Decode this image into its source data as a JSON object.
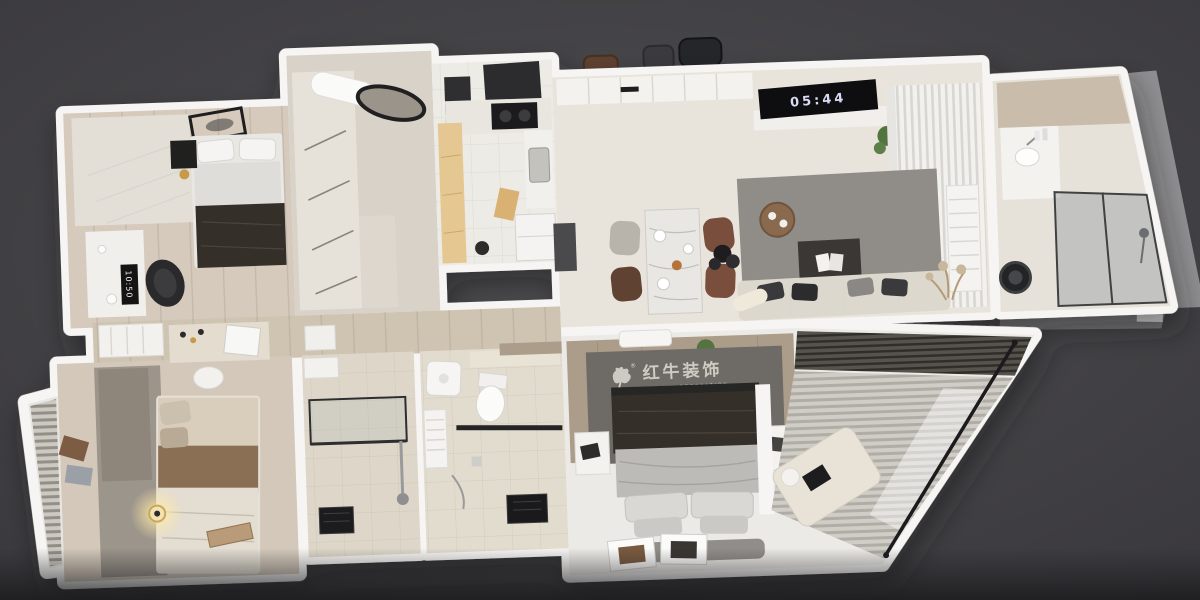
{
  "scene": {
    "background_color": "#4a494c",
    "background_edge_color": "#37363a",
    "floor_shadow_color": "#1c1c1e"
  },
  "branding": {
    "logo_text": "红牛装饰",
    "logo_subtext": "HONG NIU DECORATION",
    "trademark_symbol": "®",
    "logo_color": "#d8d4cc",
    "logo_icon": "bull-icon"
  },
  "displays": {
    "desk_clock_time": "10:50",
    "tv_clock_time": "05:44"
  },
  "palette": {
    "wall": "#f6f5f3",
    "floor_wood_light": "#d5cabb",
    "floor_closet": "#d8d2c9",
    "floor_kitchen": "#edebe6",
    "floor_cream": "#e9e4db",
    "floor_hall": "#cfc4b2",
    "floor_bedroom_bl": "#d3c8b9",
    "floor_bath_a": "#ded7c9",
    "floor_bath_b": "#e2dccf",
    "floor_bath_right": "#e6e2da",
    "floor_white": "#eceae6",
    "wood_cabinet": "#e5c791",
    "wood_wall": "#ab9d8a",
    "rug_dark": "#6e6a65",
    "rug_gray": "#908d88",
    "rug_bl": "#9c958b",
    "sofa": "#ddd8ce",
    "blanket_dark": "#352f29",
    "blanket_brown": "#8a6f55",
    "glass": "#9aa0a3",
    "plant_green": "#54743f",
    "lamp_glow": "#ffe9a8",
    "exterior_band": "#8f8f91"
  },
  "rooms": [
    {
      "name": "bedroom-upper-left"
    },
    {
      "name": "walk-in-closet"
    },
    {
      "name": "kitchen"
    },
    {
      "name": "living-dining-room"
    },
    {
      "name": "bathroom-right"
    },
    {
      "name": "hallway"
    },
    {
      "name": "bedroom-lower-left"
    },
    {
      "name": "shower-room"
    },
    {
      "name": "bathroom-middle"
    },
    {
      "name": "master-bedroom"
    }
  ]
}
